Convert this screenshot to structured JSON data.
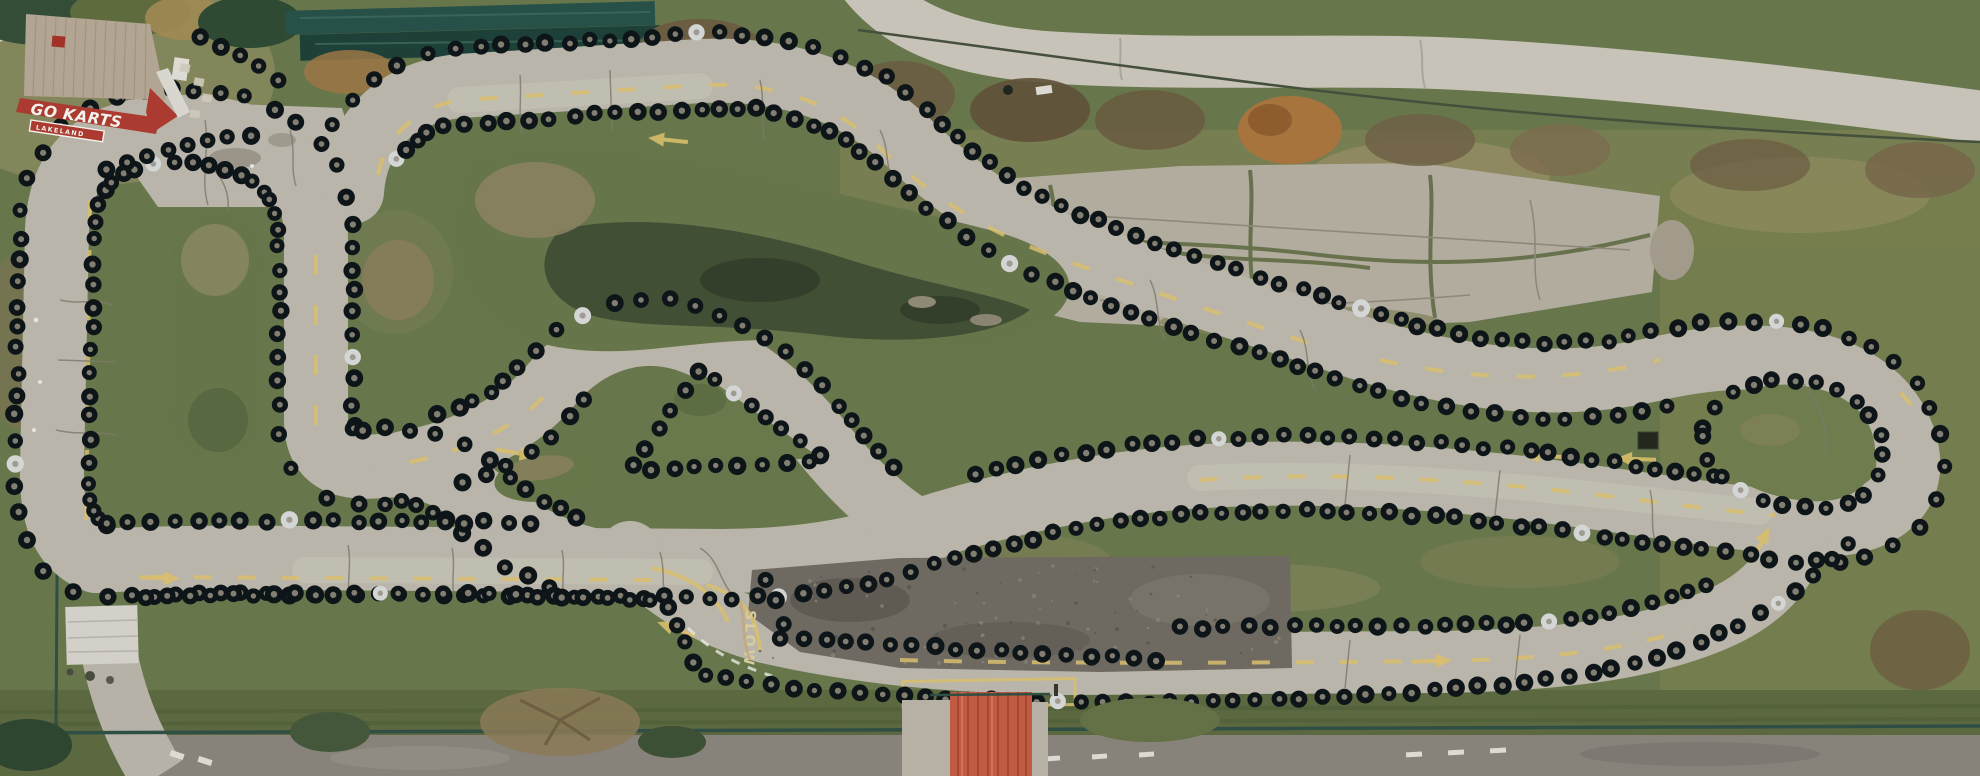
{
  "meta": {
    "description": "Aerial top-down drone photograph of a weathered outdoor go-kart track. A winding cracked asphalt circuit lined on both edges with hundreds of black tires snakes through patchy green grass. A red-fascia building reading GO KARTS sits top-left, a red corrugated-roof queue shed sits bottom-center, an abandoned cracked concrete pad lies top-right, and public roads border the top-right and bottom edges."
  },
  "labels": {
    "building_sign": "GO KARTS",
    "building_sign_sub": "LAKELAND",
    "track_pavement_marking": "SLOW"
  },
  "colors": {
    "grass_base": "#68774b",
    "grass_dark": "#4f603e",
    "grass_bright": "#6f8049",
    "grass_dry": "#938c64",
    "marsh_dark": "#414f35",
    "dirt_brown": "#8b7f5e",
    "track_asphalt": "#b9b5aa",
    "track_wear": "#c6c2b7",
    "pit_asphalt": "#6e6a61",
    "road_top": "#c7c3b8",
    "road_bottom": "#87837a",
    "concrete_pad": "#b2ac9e",
    "tire_black": "#0e1519",
    "tire_hub": "#8f897c",
    "tire_white": "#d3d6d5",
    "marking_yellow": "#d9bf6e",
    "slow_marking": "#d9cd9f",
    "marking_white": "#e8e7e2",
    "roof_metal": "#b2a593",
    "sign_red": "#ab3a30",
    "shed_red": "#c05a43",
    "shed_white": "#d3d0c9",
    "fence_teal": "#2f4f44",
    "crack": "#7d786c",
    "moss": "#5e6a42"
  }
}
